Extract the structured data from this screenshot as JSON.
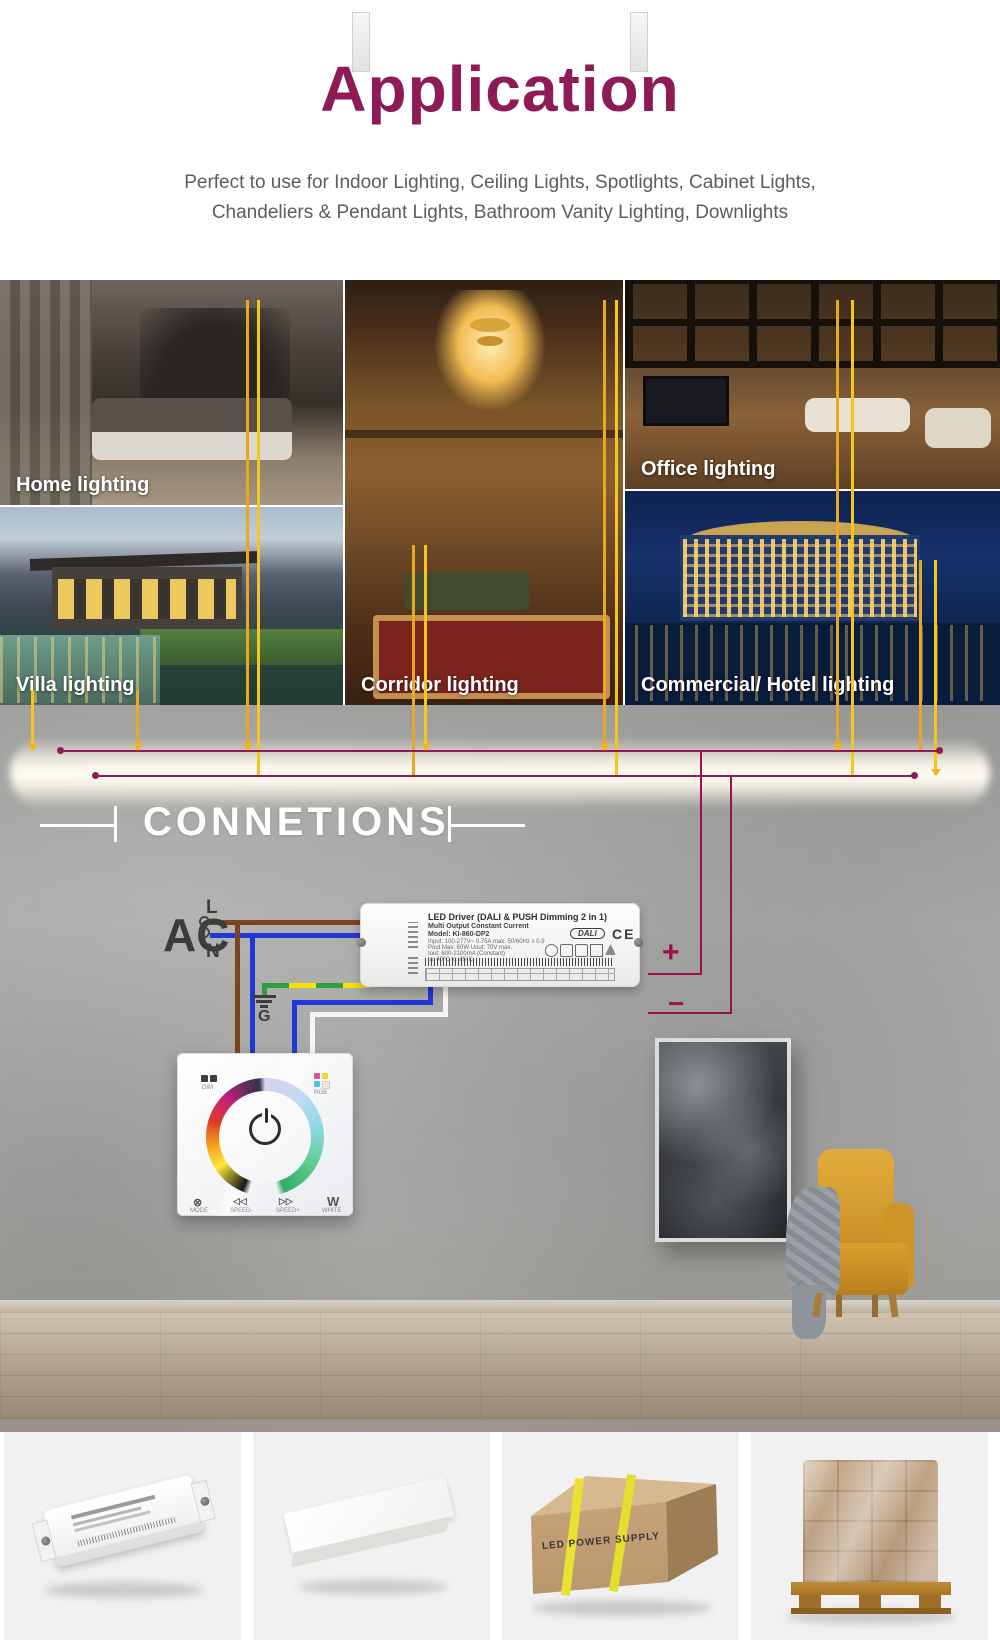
{
  "header": {
    "title": "Application",
    "subtitle_line1": "Perfect to use for Indoor Lighting, Ceiling Lights, Spotlights, Cabinet Lights,",
    "subtitle_line2": "Chandeliers & Pendant Lights, Bathroom Vanity Lighting, Downlights"
  },
  "gallery": {
    "home": "Home lighting",
    "office": "Office lighting",
    "villa": "Villa lighting",
    "corridor": "Corridor lighting",
    "commercial": "Commercial/ Hotel lighting"
  },
  "connections": {
    "heading": "CONNETIONS"
  },
  "diagram": {
    "ac": "AC",
    "line": "L",
    "neutral": "N",
    "ground": "G",
    "plus": "+",
    "minus": "−"
  },
  "driver": {
    "title": "LED Driver (DALI & PUSH Dimming 2 in 1)",
    "subtitle": "Multi Output Constant Current",
    "model": "Model: KI-860-DP2",
    "spec1": "Input: 100-277V~ 0.75A max. 50/60Hz  λ 0.9",
    "spec2": "Pout Max: 60W  Uout: 70V max.",
    "spec3": "Iout: 600-2100mA (Constant)",
    "spec4": "ta: 40°C   tc: 85°C",
    "dali": "DALI",
    "ce": "CE"
  },
  "panel": {
    "dim": "DIM",
    "rgb": "RGB",
    "icons": {
      "mode_glyph": "⊗",
      "speed_minus_glyph": "◁◁",
      "speed_plus_glyph": "▷▷",
      "white_glyph": "W"
    },
    "labels": {
      "mode": "MODE",
      "speed_minus": "SPEED-",
      "speed_plus": "SPEED+",
      "white": "WHITE"
    }
  },
  "products": {
    "box_text": "LED POWER SUPPLY"
  },
  "colors": {
    "accent": "#8e1a56",
    "overlay_yellow": "#f2b51d",
    "wire_live_brown": "#7a4420",
    "wire_neutral_blue": "#2038d8",
    "wire_ground_green": "#2f9e44",
    "wire_ground_yellow": "#f4e300",
    "wire_output_magenta": "#9c1050"
  }
}
